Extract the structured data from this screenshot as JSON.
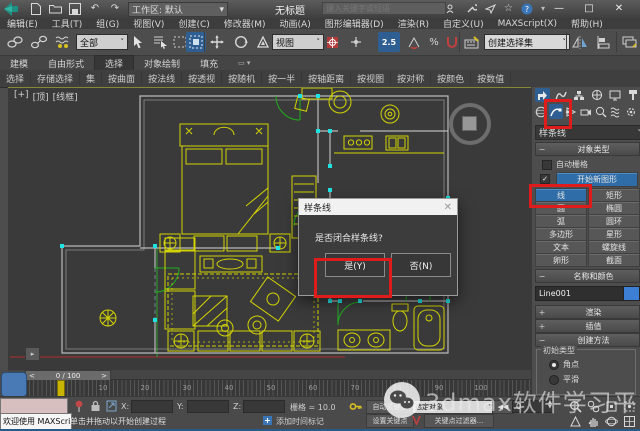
{
  "titlebar": {
    "workspace": "工作区: 默认",
    "title": "无标题",
    "search_placeholder": "键入关键字或短语",
    "minimize": "—",
    "maximize": "□",
    "close": "✕"
  },
  "menubar": {
    "items": [
      "编辑(E)",
      "工具(T)",
      "组(G)",
      "视图(V)",
      "创建(C)",
      "修改器(M)",
      "动画(A)",
      "图形编辑器(D)",
      "渲染(R)",
      "自定义(U)",
      "MAXScript(X)",
      "帮助(H)"
    ]
  },
  "toolbar": {
    "filter_value": "全部",
    "coord_value": "视图",
    "snap_label": "2.5",
    "selection_set": "创建选择集"
  },
  "ribbon": {
    "tabs": [
      "建模",
      "自由形式",
      "选择",
      "对象绘制",
      "填充"
    ],
    "active_tab": "选择",
    "items": [
      "选择",
      "存储选择",
      "集",
      "按曲面",
      "按法线",
      "按透视",
      "按随机",
      "按一半",
      "按轴距离",
      "按视图",
      "按对称",
      "按颜色",
      "按数值"
    ]
  },
  "viewport": {
    "label_plus": "[+]",
    "label_view": "[顶]",
    "label_shading": "[线框]"
  },
  "dialog": {
    "title": "样条线",
    "close": "✕",
    "message": "是否闭合样条线?",
    "yes": "是(Y)",
    "no": "否(N)"
  },
  "panel": {
    "category_dropdown": "样条线",
    "rollout_object_type": "对象类型",
    "autogrid": "自动栅格",
    "start_new_shape": "开始新图形",
    "buttons": [
      "线",
      "矩形",
      "圆",
      "椭圆",
      "弧",
      "圆环",
      "多边形",
      "星形",
      "文本",
      "螺旋线",
      "卵形",
      "截面"
    ],
    "active_button": "线",
    "rollout_name_color": "名称和颜色",
    "object_name": "Line001",
    "rollout_rendering": "渲染",
    "rollout_interpolation": "插值",
    "rollout_creation_method": "创建方法",
    "initial_type": "初始类型",
    "radio_corner": "角点",
    "radio_smooth": "平滑"
  },
  "timeline": {
    "frame_label": "0 / 100",
    "prev": "<",
    "next": ">",
    "ticks": [
      "10",
      "20",
      "30",
      "40",
      "50",
      "60",
      "70",
      "80",
      "90",
      "100"
    ]
  },
  "statusbar": {
    "listener_text": "欢迎使用 MAXScript",
    "prompt": "单击并拖动以开始创建过程",
    "x_label": "X:",
    "y_label": "Y:",
    "z_label": "Z:",
    "grid_label": "栅格 = 10.0",
    "add_time_tag": "添加时间标记",
    "auto_key": "自动关键点",
    "selected_filter": "选定对象",
    "set_key": "设置关键点",
    "key_filters": "关键点过滤器...",
    "frame_value": "0",
    "go_start": "◀◀"
  },
  "watermark": {
    "text": "3dmax软件学习平台"
  },
  "colors": {
    "furniture": "#d4d404",
    "walls": "#b9b9b9",
    "vertices": "#1fe3e3",
    "doors": "#1fae1f",
    "axis_x": "#b03030",
    "axis_y": "#30a030",
    "annotation": "#e01b1b"
  }
}
